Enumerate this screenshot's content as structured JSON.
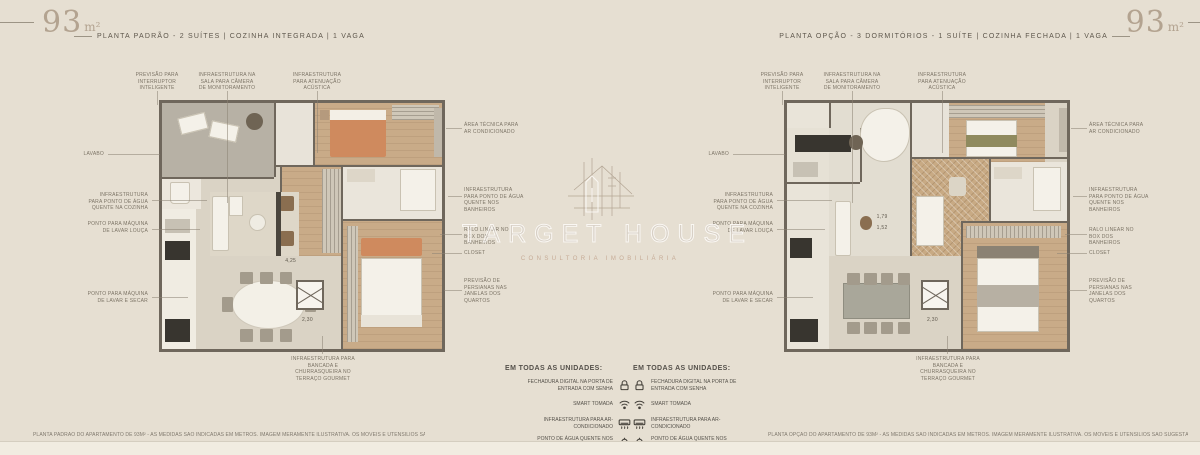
{
  "header_left": {
    "area": "93",
    "area_unit": "m²",
    "description": "PLANTA PADRÃO - 2 SUÍTES | COZINHA INTEGRADA | 1 VAGA"
  },
  "header_right": {
    "area": "93",
    "area_unit": "m²",
    "description": "PLANTA OPÇÃO - 3 DORMITÓRIOS - 1 SUÍTE | COZINHA FECHADA | 1 VAGA"
  },
  "callouts": {
    "top": [
      "PREVISÃO PARA INTERRUPTOR INTELIGENTE",
      "INFRAESTRUTURA NA SALA PARA CÂMERA DE MONITORAMENTO",
      "INFRAESTRUTURA PARA ATENUAÇÃO ACÚSTICA"
    ],
    "left": [
      "LAVABO",
      "INFRAESTRUTURA PARA PONTO DE ÁGUA QUENTE NA COZINHA",
      "PONTO PARA MÁQUINA DE LAVAR LOUÇA",
      "PONTO PARA MÁQUINA DE LAVAR E SECAR"
    ],
    "right": [
      "ÁREA TÉCNICA PARA AR CONDICIONADO",
      "INFRAESTRUTURA PARA PONTO DE ÁGUA QUENTE NOS BANHEIROS",
      "RALO LINEAR NO BOX DOS BANHEIROS",
      "CLOSET",
      "PREVISÃO DE PERSIANAS NAS JANELAS DOS QUARTOS"
    ],
    "bottom": [
      "INFRAESTRUTURA PARA BANCADA E CHURRASQUEIRA NO TERRAÇO GOURMET"
    ]
  },
  "dimensions": {
    "left_plan": [
      "4,25",
      "2,30"
    ],
    "right_plan": [
      "1,79",
      "1,52",
      "2,30"
    ]
  },
  "watermark": {
    "brand": "TARGET HOUSE",
    "tagline": "CONSULTORIA IMOBILIÁRIA",
    "logo": "house-sketch-icon"
  },
  "features": {
    "title": "EM TODAS AS UNIDADES:",
    "items": [
      {
        "text": "FECHADURA DIGITAL NA PORTA DE ENTRADA COM SENHA",
        "icon": "smart-lock-icon"
      },
      {
        "text": "SMART TOMADA",
        "icon": "wifi-icon"
      },
      {
        "text": "INFRAESTRUTURA PARA AR-CONDICIONADO",
        "icon": "ac-unit-icon"
      },
      {
        "text": "PONTO DE ÁGUA QUENTE NOS CHUVEIROS",
        "icon": "shower-icon"
      }
    ]
  },
  "disclaimers": {
    "left": "PLANTA PADRÃO DO APARTAMENTO DE 93M² - AS MEDIDAS SÃO INDICADAS EM METROS. IMAGEM MERAMENTE ILUSTRATIVA. OS MÓVEIS E UTENSÍLIOS SÃO SUGESTÃO DE DECORAÇÃO E NÃO FAZEM PARTE DO MEMORIAL DESCRITIVO.",
    "right": "PLANTA OPÇÃO DO APARTAMENTO DE 93M² - AS MEDIDAS SÃO INDICADAS EM METROS. IMAGEM MERAMENTE ILUSTRATIVA. OS MÓVEIS E UTENSÍLIOS SÃO SUGESTÃO DE DECORAÇÃO E NÃO FAZEM PARTE DO MEMORIAL DESCRITIVO."
  },
  "palette": {
    "background": "#e6dfd2",
    "wall": "#6f675c",
    "floor": "#dad3c5",
    "wood_floor": "#c9ab88",
    "terrace_gray": "#b7b1a5",
    "accent_orange": "#cf8a5e",
    "text": "#5e574c",
    "watermark_white": "#fdfbf7"
  }
}
